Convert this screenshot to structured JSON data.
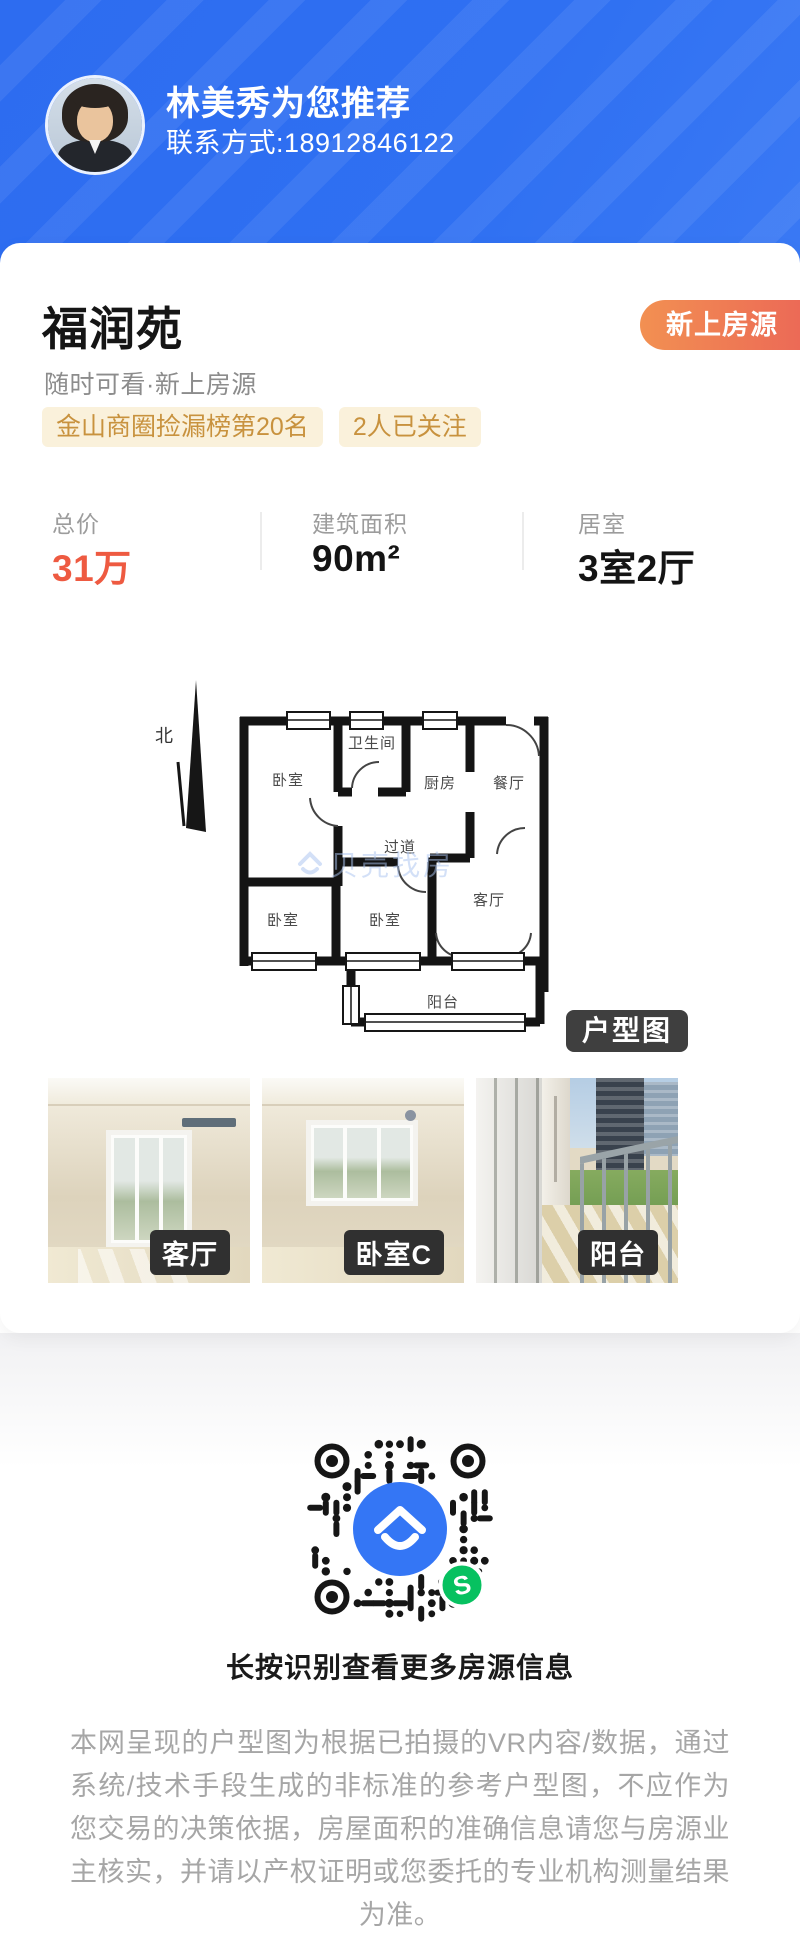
{
  "header": {
    "agent_name": "林美秀为您推荐",
    "contact": "联系方式:18912846122"
  },
  "listing": {
    "title": "福润苑",
    "badge": "新上房源",
    "subtitle": "随时可看·新上房源",
    "tags": [
      "金山商圈捡漏榜第20名",
      "2人已关注"
    ],
    "stats": [
      {
        "label": "总价",
        "value": "31万"
      },
      {
        "label": "建筑面积",
        "value": "90m²"
      },
      {
        "label": "居室",
        "value": "3室2厅"
      }
    ]
  },
  "floorplan": {
    "badge": "户型图",
    "north_label": "北",
    "watermark": "贝壳找房",
    "rooms": {
      "bedroom_tl": "卧室",
      "bathroom": "卫生间",
      "kitchen": "厨房",
      "dining": "餐厅",
      "corridor": "过道",
      "bedroom_bl": "卧室",
      "bedroom_bm": "卧室",
      "living": "客厅",
      "balcony": "阳台"
    }
  },
  "photos": [
    {
      "label": "客厅"
    },
    {
      "label": "卧室C"
    },
    {
      "label": "阳台"
    }
  ],
  "qr": {
    "caption": "长按识别查看更多房源信息"
  },
  "disclaimer": "本网呈现的户型图为根据已拍摄的VR内容/数据，通过系统/技术手段生成的非标准的参考户型图，不应作为您交易的决策依据，房屋面积的准确信息请您与房源业主核实，并请以产权证明或您委托的专业机构测量结果为准。",
  "colors": {
    "header_blue": "#2f70f2",
    "badge_orange_start": "#f29052",
    "badge_orange_end": "#ec6a56",
    "price_red": "#ee5a41",
    "tag_gold_text": "#c8923e",
    "tag_gold_bg": "#faf1db",
    "qr_logo_blue": "#3476f5",
    "wechat_green": "#07c160"
  }
}
